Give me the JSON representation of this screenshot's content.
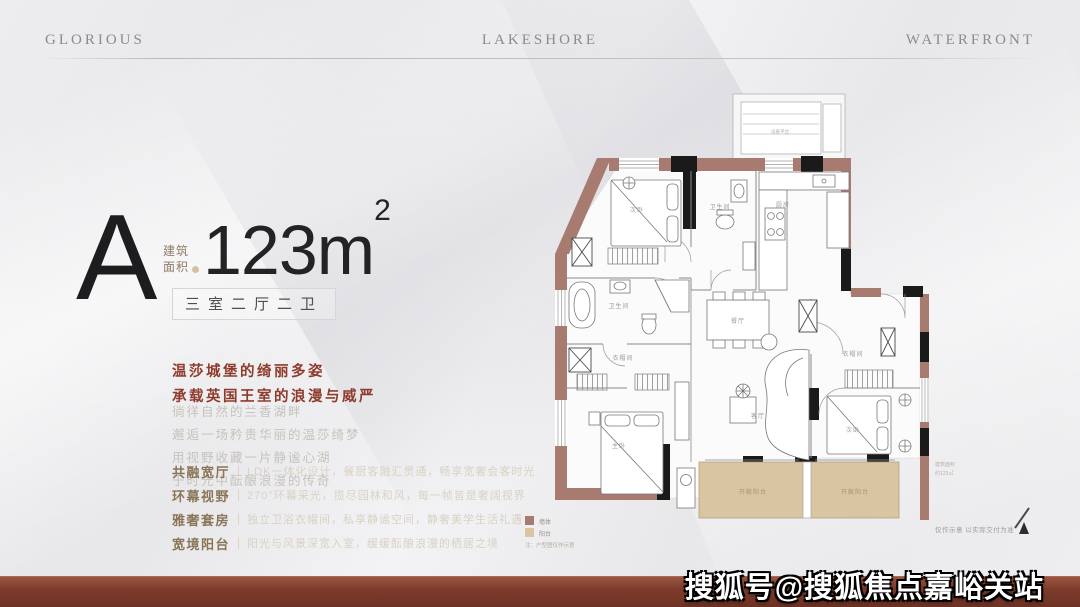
{
  "header": {
    "left": "GLORIOUS",
    "center": "LAKESHORE",
    "right": "WATERFRONT"
  },
  "unit": {
    "type_letter": "A",
    "area_label_line1": "建筑",
    "area_label_line2": "面积",
    "area_value": "123m",
    "area_sup": "2",
    "layout": "三室二厅二卫"
  },
  "headline": {
    "line1": "温莎城堡的绮丽多姿",
    "line2": "承载英国王室的浪漫与威严"
  },
  "poem": [
    "徜徉自然的兰香湖畔",
    "邂逅一场矜贵华丽的温莎绮梦",
    "用视野收藏一片静谧心湖",
    "于时光中酝酿浪漫的传奇"
  ],
  "features": [
    {
      "label": "共融宽厅",
      "desc": "LDK一体化设计，餐厨客融汇贯通，畅享宽奢会客时光"
    },
    {
      "label": "环幕视野",
      "desc": "270°环幕采光，揽尽园林和风，每一帧皆是奢阔视界"
    },
    {
      "label": "雅奢套房",
      "desc": "独立卫浴衣帽间，私享静谧空间，静奢美学生活礼遇"
    },
    {
      "label": "宽境阳台",
      "desc": "阳光与风景深宽入室，缓缓酝酿浪漫的栖居之境"
    }
  ],
  "floorplan": {
    "rooms": {
      "platform": "设备平台",
      "bedroom_top": "次卧",
      "bath_top": "卫生间",
      "kitchen": "厨房",
      "dining": "餐厅",
      "living": "客厅",
      "master_bath": "卫生间",
      "closet_left": "衣帽间",
      "master": "主卧",
      "closet_right": "衣帽间",
      "bedroom_right": "次卧",
      "balcony_left": "开敞阳台",
      "balcony_right": "开敞阳台"
    },
    "legend": [
      {
        "swatch": "#a87b70",
        "label": "墙体"
      },
      {
        "swatch": "#d9c5a2",
        "label": "阳台"
      }
    ],
    "legend_note": "注：户型图仅作示意",
    "plan_note_1": "建筑面积",
    "plan_note_2": "约123㎡",
    "disclaimer": "仅作示意 以实际交付为准",
    "compass": "N"
  },
  "watermark": "搜狐号@搜狐焦点嘉峪关站",
  "colors": {
    "accent_red": "#8e3b2c",
    "wall_red": "#a87b70",
    "wall_black": "#1a1a1a",
    "balcony_tan": "#d9c5a2",
    "bar_maroon": "#7b3a2a",
    "header_gray": "#8b8b8b"
  }
}
